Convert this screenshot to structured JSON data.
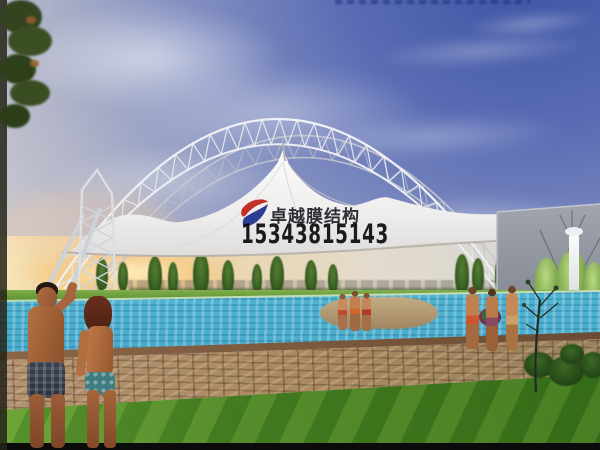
{
  "watermark": {
    "logo_icon": "red-blue-swoosh-logo",
    "brand": "卓越膜结构",
    "phone": "15343815143"
  },
  "colors": {
    "sky_deep_blue": "#3a51a2",
    "sky_light_gray": "#d2d0d2",
    "sunset_gold": "#f3cf92",
    "membrane_white": "#f5f4f2",
    "steel_truss_gray": "#e8eaef",
    "wall_gray": "#8d919c",
    "pool_blue": "#55b8d6",
    "deck_tan": "#a9895f",
    "grass_green": "#498423",
    "watermark_logo_red": "#c23127",
    "watermark_logo_blue": "#2b3f93",
    "watermark_text_dark": "#15181c"
  }
}
